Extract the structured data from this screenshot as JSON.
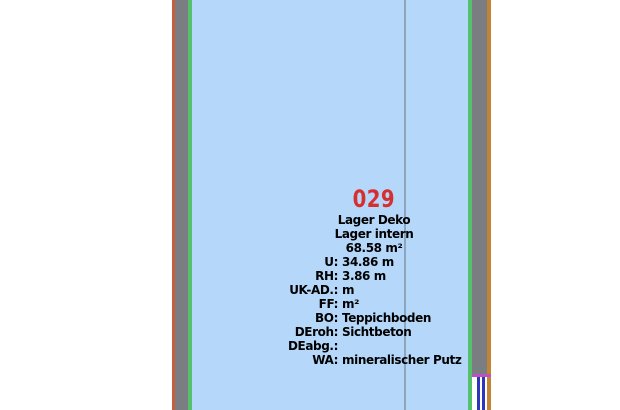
{
  "room_stamp": {
    "number": "029",
    "name_line1": "Lager Deko",
    "name_line2": "Lager intern",
    "area": "68.58 m²",
    "attributes": [
      {
        "label": "U:",
        "value": "34.86 m"
      },
      {
        "label": "RH:",
        "value": "3.86 m"
      },
      {
        "label": "UK-AD.:",
        "value": "m"
      },
      {
        "label": "FF:",
        "value": "m²"
      },
      {
        "label": "BO:",
        "value": "Teppichboden"
      },
      {
        "label": "DEroh:",
        "value": "Sichtbeton"
      },
      {
        "label": "DEabg.:",
        "value": ""
      },
      {
        "label": "WA:",
        "value": "mineralischer Putz"
      }
    ]
  },
  "colors": {
    "background": "#ffffff",
    "room_fill": "#b5d8fa",
    "wall_gray": "#7a7e82",
    "edge_green": "#56c16c",
    "edge_orange_left": "#c4613b",
    "edge_orange_right": "#c08434",
    "grid_line_blue_gray": "#8ea5be",
    "room_number_red": "#d62f2f",
    "lintel_magenta": "#c050c0",
    "window_glazing_blue": "#2b36bd",
    "text": "#000000"
  }
}
